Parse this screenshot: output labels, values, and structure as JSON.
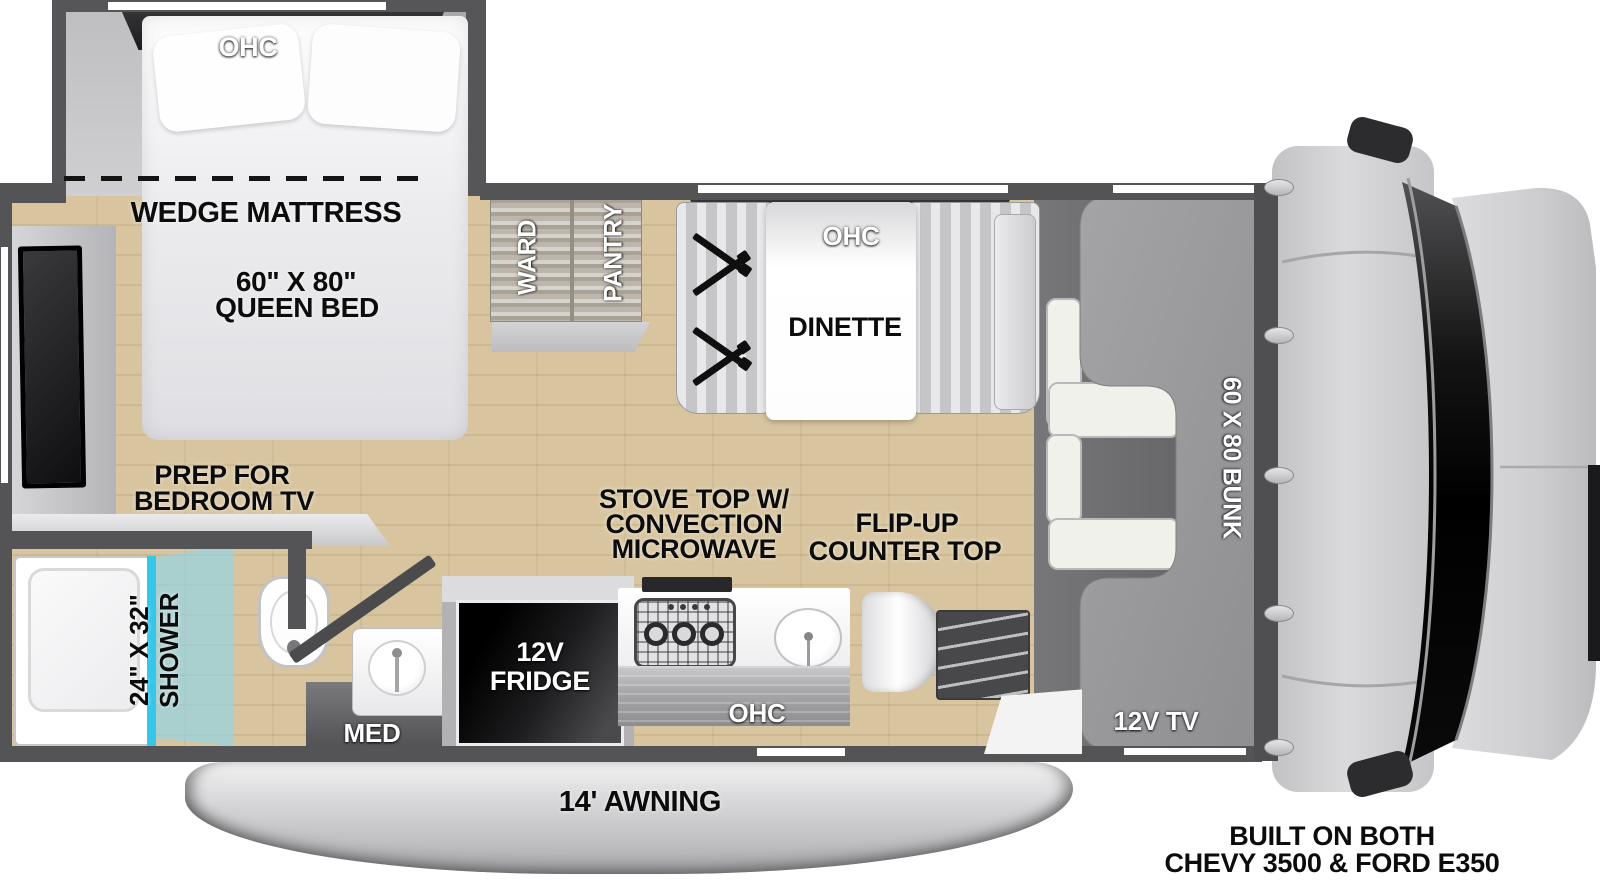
{
  "diagram": {
    "kind": "RV floor plan, Class C motorhome, top-down view"
  },
  "bedroom": {
    "ohc": "OHC",
    "mattress": "WEDGE MATTRESS",
    "bed_size": "60\" X 80\"",
    "bed_type": "QUEEN BED",
    "tv_prep_line1": "PREP FOR",
    "tv_prep_line2": "BEDROOM TV"
  },
  "storage": {
    "ward": "WARD",
    "pantry": "PANTRY"
  },
  "dinette": {
    "ohc": "OHC",
    "label": "DINETTE"
  },
  "bath": {
    "shower_size": "24\" X 32\"",
    "shower": "SHOWER",
    "med": "MED"
  },
  "kitchen": {
    "fridge_line1": "12V",
    "fridge_line2": "FRIDGE",
    "ohc": "OHC",
    "stove_line1": "STOVE TOP W/",
    "stove_line2": "CONVECTION",
    "stove_line3": "MICROWAVE",
    "flip_line1": "FLIP-UP",
    "flip_line2": "COUNTER TOP"
  },
  "exterior": {
    "awning": "14' AWNING"
  },
  "cab": {
    "bunk": "60 X 80 BUNK",
    "tv": "12V TV"
  },
  "chassis": {
    "line1": "BUILT ON BOTH",
    "line2": "CHEVY 3500 & FORD E350"
  },
  "colors": {
    "wall": "#545457",
    "wood_floor": "#d8c5a0",
    "shower_glass": "#35c6ea",
    "bunk_panel": "#9b9b9e",
    "label_dark": "#0c0c0c",
    "label_light": "#ffffff"
  }
}
